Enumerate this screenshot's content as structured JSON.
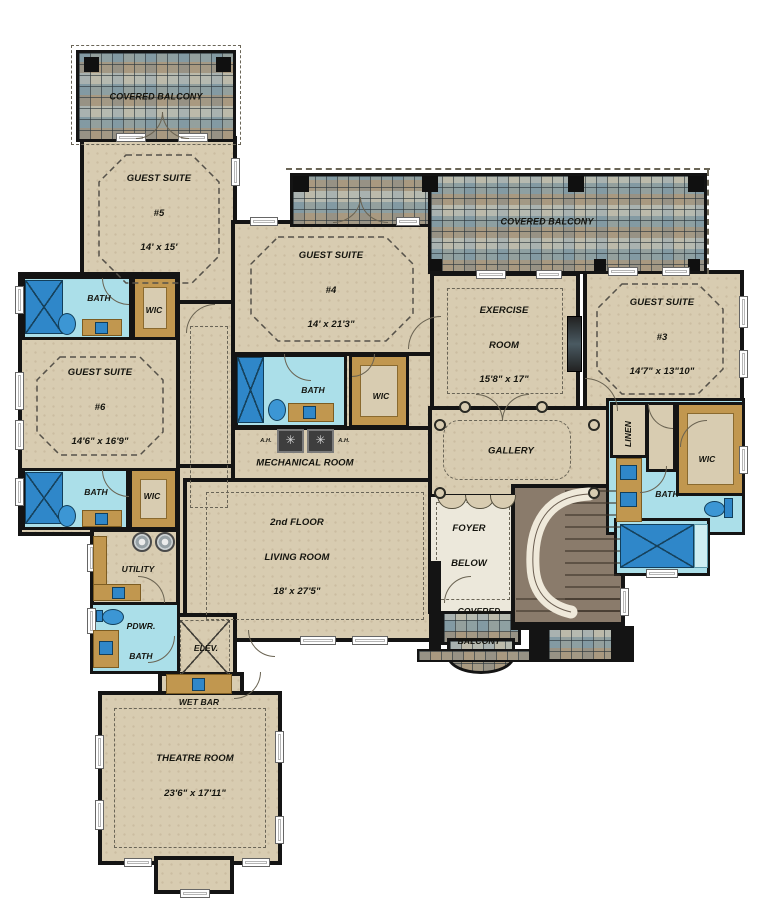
{
  "rooms": {
    "covered_balcony": {
      "label": "COVERED BALCONY",
      "l1": "COVERED",
      "l2": "BALCONY"
    },
    "guest_suite_5": {
      "name": "GUEST SUITE",
      "num": "#5",
      "dims": "14' x 15'"
    },
    "guest_suite_4": {
      "name": "GUEST SUITE",
      "num": "#4",
      "dims": "14' x 21'3\""
    },
    "guest_suite_3": {
      "name": "GUEST SUITE",
      "num": "#3",
      "dims": "14'7\" x 13\"10\""
    },
    "guest_suite_6": {
      "name": "GUEST SUITE",
      "num": "#6",
      "dims": "14'6\" x 16'9\""
    },
    "exercise_room": {
      "l1": "EXERCISE",
      "l2": "ROOM",
      "dims": "15'8\" x 17\""
    },
    "living_room": {
      "l1": "2nd FLOOR",
      "l2": "LIVING ROOM",
      "dims": "18' x 27'5\""
    },
    "theatre_room": {
      "name": "THEATRE ROOM",
      "dims": "23'6\" x 17'11\""
    },
    "mechanical_room": {
      "label": "MECHANICAL ROOM",
      "air_handler": "A.H."
    },
    "gallery": {
      "label": "GALLERY"
    },
    "foyer": {
      "l1": "FOYER",
      "l2": "BELOW"
    },
    "linen": {
      "label": "LINEN"
    },
    "utility": {
      "label": "UTILITY"
    },
    "powder_bath": {
      "l1": "PDWR.",
      "l2": "BATH"
    },
    "elevator": {
      "label": "ELEV."
    },
    "wet_bar": {
      "label": "WET BAR"
    },
    "bath": {
      "label": "BATH"
    },
    "wic": {
      "label": "WIC"
    }
  },
  "icons": {
    "fan": "✳"
  },
  "colors": {
    "floor": "#d8ccb1",
    "bath_floor": "#abdfe9",
    "fixture_blue": "#2f87c9",
    "cabinet_tan": "#c1974f",
    "wall": "#141414",
    "stair_brown": "#8a7b6b",
    "foyer_floor": "#ece8db",
    "tile_base": "#b2bab3"
  }
}
